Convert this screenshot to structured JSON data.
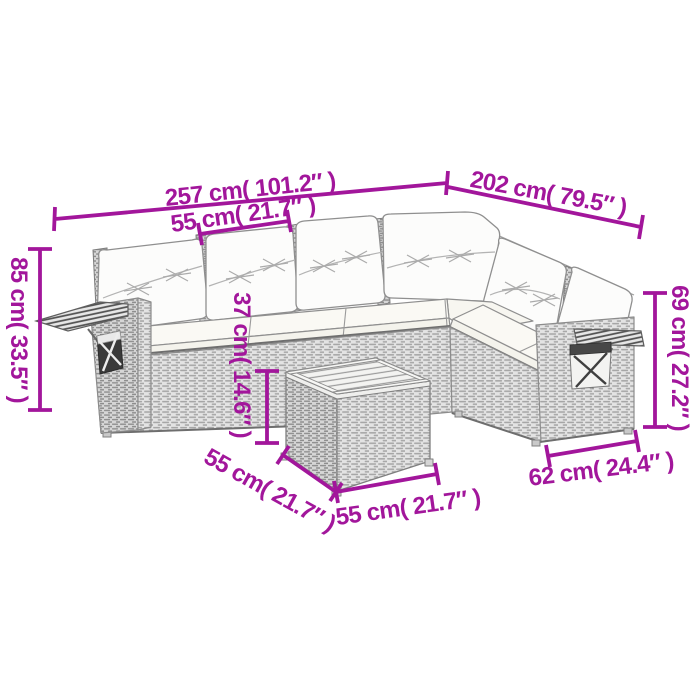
{
  "accent_color": "#A2169B",
  "illustration": "7-piece L-shaped rattan garden lounge set with cushions, corner sofa, side trays, storage pockets and square slatted-top coffee table, line drawing with dimension arrows",
  "measurements": {
    "total_length_left": "257 cm( 101.2″ )",
    "seat_width": "55 cm( 21.7″ )",
    "total_length_right": "202 cm( 79.5″ )",
    "total_height": "85 cm( 33.5″ )",
    "backrest_height": "69 cm( 27.2″ )",
    "table_height": "37 cm( 14.6″ )",
    "table_depth": "55 cm( 21.7″ )",
    "table_width": "55 cm( 21.7″ )",
    "armrest_section_width": "62 cm( 24.4″ )"
  }
}
